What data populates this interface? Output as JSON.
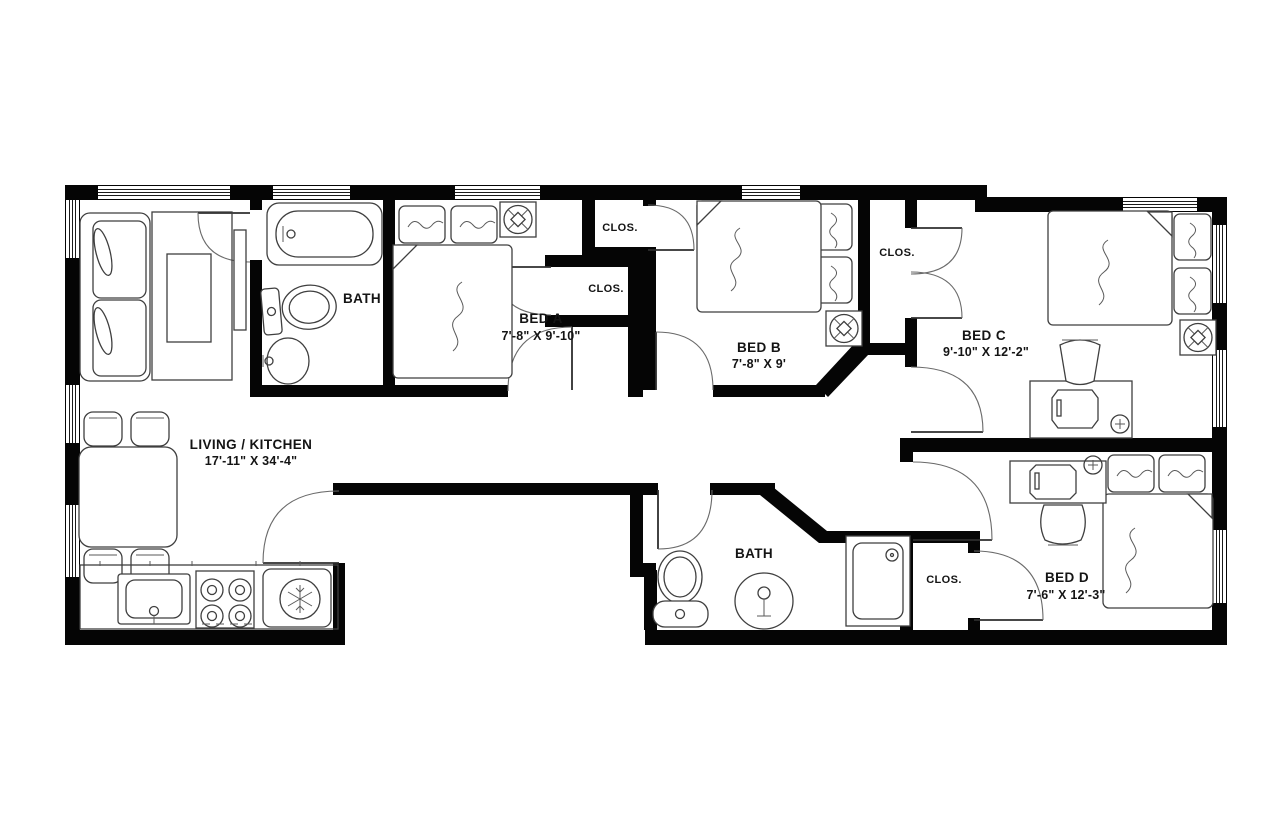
{
  "rooms": {
    "living_kitchen": {
      "name": "LIVING / KITCHEN",
      "dims": "17'-11\" X 34'-4\""
    },
    "bath_upper": {
      "name": "BATH"
    },
    "bath_lower": {
      "name": "BATH"
    },
    "bed_a": {
      "name": "BED A",
      "dims": "7'-8\" X 9'-10\""
    },
    "bed_b": {
      "name": "BED B",
      "dims": "7'-8\" X 9'"
    },
    "bed_c": {
      "name": "BED C",
      "dims": "9'-10\" X 12'-2\""
    },
    "bed_d": {
      "name": "BED D",
      "dims": "7'-6\" X 12'-3\""
    },
    "closet_bed_b": {
      "name": "CLOS."
    },
    "closet_bed_a": {
      "name": "CLOS."
    },
    "closet_bed_c": {
      "name": "CLOS."
    },
    "closet_bed_d": {
      "name": "CLOS."
    }
  },
  "colors": {
    "wall": "#050505",
    "background": "#ffffff",
    "furniture_line": "#3f3f3f",
    "text": "#141414"
  }
}
